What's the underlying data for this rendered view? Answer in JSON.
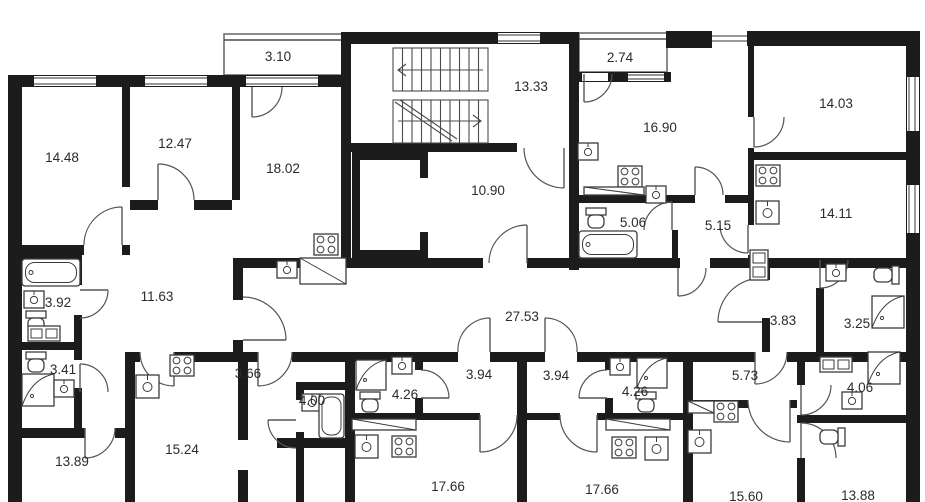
{
  "floor_plan": {
    "colors": {
      "wall": "#1c1c1c",
      "line": "#4a4a4a",
      "label": "#2b2b2b",
      "background": "#ffffff"
    },
    "icons": [
      "bathtub-icon",
      "toilet-icon",
      "sink-icon",
      "shower-icon",
      "stove-icon",
      "washer-icon",
      "counter-icon",
      "stairs-icon",
      "elevator-icon"
    ],
    "unit_labels": [
      {
        "area": "3.10"
      },
      {
        "area": "14.48"
      },
      {
        "area": "12.47"
      },
      {
        "area": "18.02"
      },
      {
        "area": "13.33"
      },
      {
        "area": "10.90"
      },
      {
        "area": "2.74"
      },
      {
        "area": "16.90"
      },
      {
        "area": "14.03"
      },
      {
        "area": "5.06"
      },
      {
        "area": "5.15"
      },
      {
        "area": "14.11"
      },
      {
        "area": "3.92"
      },
      {
        "area": "11.63"
      },
      {
        "area": "3.41"
      },
      {
        "area": "3.66"
      },
      {
        "area": "27.53"
      },
      {
        "area": "3.83"
      },
      {
        "area": "3.25"
      },
      {
        "area": "4.00"
      },
      {
        "area": "4.26"
      },
      {
        "area": "3.94"
      },
      {
        "area": "3.94"
      },
      {
        "area": "4.26"
      },
      {
        "area": "5.73"
      },
      {
        "area": "4.06"
      },
      {
        "area": "13.89"
      },
      {
        "area": "15.24"
      },
      {
        "area": "17.66"
      },
      {
        "area": "17.66"
      },
      {
        "area": "15.60"
      },
      {
        "area": "13.88"
      }
    ]
  }
}
